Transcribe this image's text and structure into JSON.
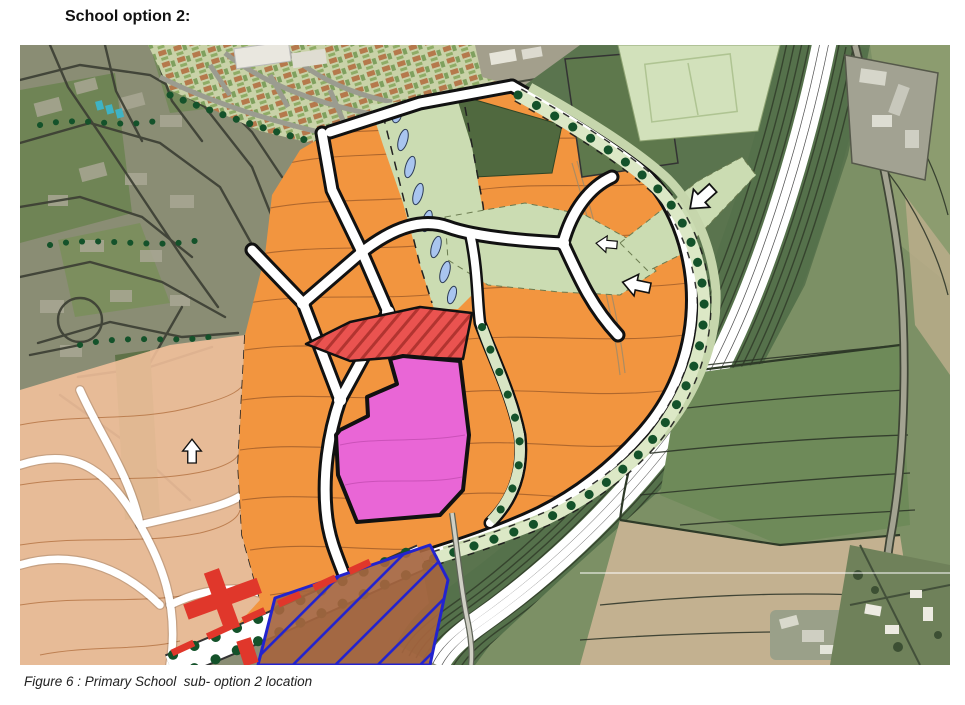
{
  "document": {
    "heading": "School option 2:",
    "caption": "Figure 6 : Primary School  sub- option 2 location"
  },
  "map": {
    "type": "masterplan-over-aerial-photo",
    "palette": {
      "parcel_orange": "#F2953F",
      "parcel_salmon": "#F4C29C",
      "school_magenta": "#E966D6",
      "reserve_red": "#EA5350",
      "hatch_red_dark": "#B23430",
      "green_light": "#CBDCB2",
      "green_dark": "#50693F",
      "pitch_green": "#5E784C",
      "pitch_light": "#D2E1BB",
      "tree_green": "#14522A",
      "pond_blue": "#A9C5EF",
      "aerial_urban": "#8A8D74",
      "aerial_field": "#7C9065",
      "field_dark": "#6E8A59",
      "field_tan": "#C3B190",
      "verge_green": "#5A744E",
      "hatch_blue": "#2323CE",
      "parcel_brown": "#A5653F",
      "red_dash": "#E0372B",
      "contour_brown": "#A8622C",
      "street_dark": "#3B3E33"
    },
    "features": [
      {
        "name": "school-site-parcel",
        "color": "#E966D6"
      },
      {
        "name": "reserved-parcel-red-hatch",
        "color": "#EA5350"
      },
      {
        "name": "development-parcels",
        "color": "#F2953F"
      },
      {
        "name": "later-phase-area",
        "color": "#F4C29C"
      },
      {
        "name": "green-corridor-with-ponds",
        "color": "#CBDCB2"
      },
      {
        "name": "tree-lined-avenue",
        "color": "#14522A"
      },
      {
        "name": "blue-hatched-parcel",
        "color": "#2323CE"
      },
      {
        "name": "bypass-corridor",
        "color": "#5A744E"
      }
    ]
  }
}
